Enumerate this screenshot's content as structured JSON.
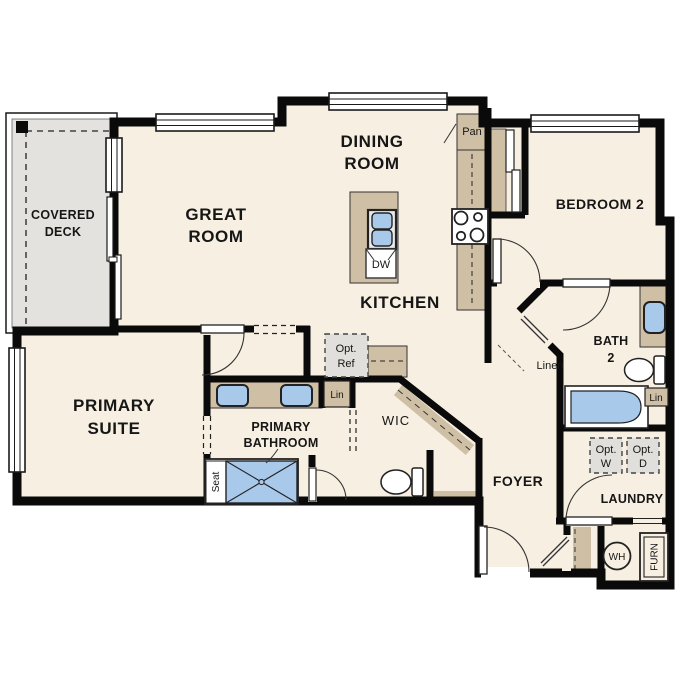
{
  "title": "Single-level residence floor plan",
  "colors": {
    "floor": "#f7efe2",
    "deck": "#e3e2de",
    "counter_tan": "#cfc0a5",
    "fixture_blue": "#a9c9eb",
    "optional_gray": "#e0dfdc",
    "wall": "#0a0a0a"
  },
  "rooms": {
    "covered_deck": {
      "line1": "COVERED",
      "line2": "DECK"
    },
    "great_room": {
      "line1": "GREAT",
      "line2": "ROOM"
    },
    "dining_room": {
      "line1": "DINING",
      "line2": "ROOM"
    },
    "kitchen": {
      "label": "KITCHEN"
    },
    "bedroom2": {
      "label": "BEDROOM 2"
    },
    "bath2": {
      "line1": "BATH",
      "line2": "2"
    },
    "primary_suite": {
      "line1": "PRIMARY",
      "line2": "SUITE"
    },
    "primary_bathroom": {
      "line1": "PRIMARY",
      "line2": "BATHROOM"
    },
    "wic": {
      "label": "WIC"
    },
    "foyer": {
      "label": "FOYER"
    },
    "laundry": {
      "label": "LAUNDRY"
    }
  },
  "fixtures": {
    "pantry": "Pan",
    "dishwasher": "DW",
    "opt_ref": {
      "line1": "Opt.",
      "line2": "Ref"
    },
    "opt_washer": {
      "line1": "Opt.",
      "line2": "W"
    },
    "opt_dryer": {
      "line1": "Opt.",
      "line2": "D"
    },
    "linen_closet": "Linen",
    "lin_primary": "Lin",
    "lin_bath2": "Lin",
    "shower_seat": "Seat",
    "water_heater": "WH",
    "furnace": "FURN"
  }
}
